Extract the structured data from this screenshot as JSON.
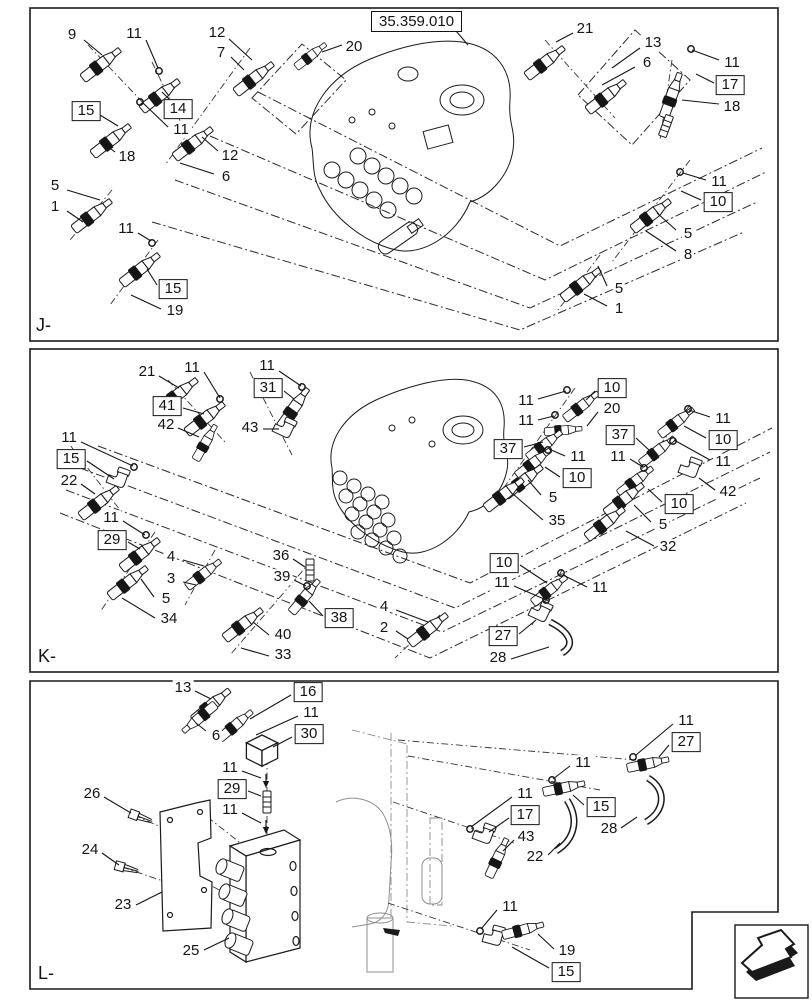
{
  "figure": {
    "reference_code": "35.359.010",
    "type": "hydraulic-valve-parts-diagram"
  },
  "colors": {
    "ink": "#1a1a1a",
    "frame_gray": "#8f8f8f"
  },
  "nav_arrow": {
    "meaning": "page-direction-arrow"
  },
  "panels": [
    {
      "id": "J",
      "label": "J-",
      "callouts": [
        {
          "t": "9",
          "x": 72,
          "y": 35,
          "l": [
            84,
            40,
            102,
            55
          ]
        },
        {
          "t": "11",
          "x": 134,
          "y": 34,
          "l": [
            146,
            40,
            158,
            68
          ]
        },
        {
          "t": "12",
          "x": 217,
          "y": 33,
          "l": [
            229,
            39,
            252,
            60
          ]
        },
        {
          "t": "7",
          "x": 221,
          "y": 53,
          "l": [
            231,
            57,
            244,
            70
          ]
        },
        {
          "t": "15",
          "b": 1,
          "x": 86,
          "y": 111,
          "l": [
            100,
            115,
            118,
            126
          ]
        },
        {
          "t": "14",
          "b": 1,
          "x": 178,
          "y": 109,
          "l": [
            170,
            100,
            162,
            92
          ]
        },
        {
          "t": "11",
          "x": 181,
          "y": 130,
          "l": [
            168,
            127,
            143,
            103
          ]
        },
        {
          "t": "18",
          "x": 127,
          "y": 157,
          "l": [
            115,
            152,
            102,
            142
          ]
        },
        {
          "t": "12",
          "x": 230,
          "y": 156,
          "l": [
            218,
            151,
            202,
            137
          ]
        },
        {
          "t": "6",
          "x": 226,
          "y": 177,
          "l": [
            214,
            174,
            180,
            163
          ]
        },
        {
          "t": "20",
          "x": 354,
          "y": 47,
          "l": [
            342,
            45,
            322,
            52
          ]
        },
        {
          "t": "21",
          "x": 585,
          "y": 29,
          "l": [
            573,
            33,
            556,
            42
          ]
        },
        {
          "t": "13",
          "x": 653,
          "y": 43,
          "l": [
            640,
            48,
            612,
            68
          ]
        },
        {
          "t": "6",
          "x": 647,
          "y": 63,
          "l": [
            635,
            67,
            602,
            85
          ]
        },
        {
          "t": "11",
          "x": 732,
          "y": 63,
          "l": [
            719,
            60,
            692,
            50
          ]
        },
        {
          "t": "17",
          "b": 1,
          "x": 730,
          "y": 85,
          "l": [
            714,
            83,
            696,
            74
          ]
        },
        {
          "t": "18",
          "x": 732,
          "y": 107,
          "l": [
            719,
            104,
            682,
            100
          ]
        },
        {
          "t": "11",
          "x": 719,
          "y": 182,
          "l": [
            706,
            180,
            683,
            173
          ]
        },
        {
          "t": "10",
          "b": 1,
          "x": 718,
          "y": 202,
          "l": [
            701,
            200,
            681,
            191
          ]
        },
        {
          "t": "5",
          "x": 688,
          "y": 234,
          "l": [
            676,
            230,
            657,
            213
          ]
        },
        {
          "t": "8",
          "x": 688,
          "y": 255,
          "l": [
            676,
            251,
            646,
            231
          ]
        },
        {
          "t": "5",
          "x": 619,
          "y": 289,
          "l": [
            607,
            286,
            598,
            266
          ]
        },
        {
          "t": "1",
          "x": 619,
          "y": 309,
          "l": [
            607,
            306,
            584,
            294
          ]
        },
        {
          "t": "5",
          "x": 55,
          "y": 186,
          "l": [
            67,
            190,
            100,
            200
          ]
        },
        {
          "t": "1",
          "x": 55,
          "y": 207,
          "l": [
            67,
            211,
            83,
            222
          ]
        },
        {
          "t": "11",
          "x": 126,
          "y": 229,
          "l": [
            138,
            233,
            151,
            241
          ]
        },
        {
          "t": "15",
          "b": 1,
          "x": 173,
          "y": 289,
          "l": [
            157,
            285,
            147,
            269
          ]
        },
        {
          "t": "19",
          "x": 175,
          "y": 311,
          "l": [
            161,
            309,
            131,
            295
          ]
        }
      ]
    },
    {
      "id": "K",
      "label": "K-",
      "callouts": [
        {
          "t": "21",
          "x": 147,
          "y": 372,
          "l": [
            159,
            376,
            179,
            388
          ]
        },
        {
          "t": "11",
          "x": 192,
          "y": 368,
          "l": [
            204,
            372,
            220,
            398
          ]
        },
        {
          "t": "41",
          "b": 1,
          "x": 167,
          "y": 406,
          "l": [
            183,
            408,
            204,
            414
          ]
        },
        {
          "t": "42",
          "x": 166,
          "y": 425,
          "l": [
            178,
            428,
            199,
            437
          ]
        },
        {
          "t": "11",
          "x": 267,
          "y": 366,
          "l": [
            279,
            371,
            301,
            386
          ]
        },
        {
          "t": "31",
          "b": 1,
          "x": 268,
          "y": 388,
          "l": [
            284,
            391,
            294,
            399
          ]
        },
        {
          "t": "43",
          "x": 250,
          "y": 428,
          "l": [
            263,
            429,
            279,
            429
          ]
        },
        {
          "t": "11",
          "x": 69,
          "y": 438,
          "l": [
            81,
            442,
            133,
            466
          ]
        },
        {
          "t": "15",
          "b": 1,
          "x": 71,
          "y": 459,
          "l": [
            87,
            461,
            114,
            479
          ]
        },
        {
          "t": "22",
          "x": 69,
          "y": 481,
          "l": [
            81,
            484,
            95,
            494
          ]
        },
        {
          "t": "11",
          "x": 111,
          "y": 518,
          "l": [
            123,
            521,
            145,
            535
          ]
        },
        {
          "t": "29",
          "b": 1,
          "x": 112,
          "y": 540,
          "l": [
            128,
            542,
            140,
            549
          ]
        },
        {
          "t": "5",
          "x": 166,
          "y": 599,
          "l": [
            154,
            597,
            141,
            579
          ]
        },
        {
          "t": "34",
          "x": 169,
          "y": 619,
          "l": [
            155,
            618,
            122,
            598
          ]
        },
        {
          "t": "4",
          "x": 171,
          "y": 557,
          "l": [
            183,
            560,
            204,
            566
          ]
        },
        {
          "t": "3",
          "x": 171,
          "y": 579,
          "l": [
            183,
            582,
            196,
            585
          ]
        },
        {
          "t": "36",
          "x": 281,
          "y": 556,
          "l": [
            293,
            559,
            305,
            567
          ]
        },
        {
          "t": "39",
          "x": 282,
          "y": 577,
          "l": [
            294,
            580,
            306,
            586
          ]
        },
        {
          "t": "40",
          "x": 283,
          "y": 635,
          "l": [
            269,
            635,
            253,
            622
          ]
        },
        {
          "t": "33",
          "x": 283,
          "y": 655,
          "l": [
            269,
            656,
            241,
            648
          ]
        },
        {
          "t": "38",
          "b": 1,
          "x": 339,
          "y": 618,
          "l": [
            323,
            616,
            309,
            601
          ]
        },
        {
          "t": "4",
          "x": 384,
          "y": 607,
          "l": [
            396,
            610,
            428,
            622
          ]
        },
        {
          "t": "2",
          "x": 384,
          "y": 628,
          "l": [
            396,
            631,
            408,
            639
          ]
        },
        {
          "t": "10",
          "b": 1,
          "x": 504,
          "y": 563,
          "l": [
            520,
            565,
            547,
            583
          ]
        },
        {
          "t": "11",
          "x": 502,
          "y": 583,
          "l": [
            514,
            586,
            544,
            599
          ]
        },
        {
          "t": "27",
          "b": 1,
          "x": 503,
          "y": 636,
          "l": [
            519,
            634,
            536,
            620
          ]
        },
        {
          "t": "28",
          "x": 498,
          "y": 658,
          "l": [
            511,
            659,
            549,
            647
          ]
        },
        {
          "t": "11",
          "x": 600,
          "y": 588,
          "l": [
            587,
            587,
            563,
            575
          ]
        },
        {
          "t": "11",
          "x": 526,
          "y": 401,
          "l": [
            538,
            399,
            566,
            391
          ]
        },
        {
          "t": "11",
          "x": 526,
          "y": 421,
          "l": [
            538,
            420,
            554,
            416
          ]
        },
        {
          "t": "10",
          "b": 1,
          "x": 612,
          "y": 388,
          "l": [
            595,
            391,
            586,
            400
          ]
        },
        {
          "t": "20",
          "x": 612,
          "y": 409,
          "l": [
            598,
            412,
            587,
            426
          ]
        },
        {
          "t": "37",
          "b": 1,
          "x": 508,
          "y": 449,
          "l": [
            524,
            447,
            543,
            442
          ]
        },
        {
          "t": "11",
          "x": 578,
          "y": 457,
          "l": [
            565,
            456,
            549,
            449
          ]
        },
        {
          "t": "10",
          "b": 1,
          "x": 577,
          "y": 478,
          "l": [
            560,
            477,
            545,
            467
          ]
        },
        {
          "t": "5",
          "x": 553,
          "y": 498,
          "l": [
            541,
            495,
            528,
            480
          ]
        },
        {
          "t": "35",
          "x": 557,
          "y": 521,
          "l": [
            543,
            520,
            513,
            494
          ]
        },
        {
          "t": "11",
          "x": 723,
          "y": 419,
          "l": [
            710,
            417,
            689,
            410
          ]
        },
        {
          "t": "10",
          "b": 1,
          "x": 723,
          "y": 440,
          "l": [
            706,
            438,
            684,
            426
          ]
        },
        {
          "t": "11",
          "x": 723,
          "y": 462,
          "l": [
            710,
            460,
            674,
            440
          ]
        },
        {
          "t": "42",
          "x": 728,
          "y": 492,
          "l": [
            715,
            490,
            699,
            478
          ]
        },
        {
          "t": "37",
          "b": 1,
          "x": 620,
          "y": 435,
          "l": [
            636,
            438,
            649,
            450
          ]
        },
        {
          "t": "11",
          "x": 618,
          "y": 457,
          "l": [
            630,
            459,
            643,
            467
          ]
        },
        {
          "t": "10",
          "b": 1,
          "x": 679,
          "y": 504,
          "l": [
            662,
            502,
            648,
            489
          ]
        },
        {
          "t": "5",
          "x": 663,
          "y": 525,
          "l": [
            651,
            522,
            634,
            505
          ]
        },
        {
          "t": "32",
          "x": 668,
          "y": 547,
          "l": [
            654,
            546,
            626,
            531
          ]
        }
      ]
    },
    {
      "id": "L",
      "label": "L-",
      "callouts": [
        {
          "t": "13",
          "x": 183,
          "y": 688,
          "l": [
            195,
            691,
            211,
            699
          ]
        },
        {
          "t": "16",
          "b": 1,
          "x": 308,
          "y": 692,
          "l": [
            291,
            695,
            250,
            719
          ]
        },
        {
          "t": "11",
          "x": 311,
          "y": 713,
          "l": [
            298,
            716,
            256,
            735
          ]
        },
        {
          "t": "30",
          "b": 1,
          "x": 309,
          "y": 734,
          "l": [
            292,
            737,
            273,
            747
          ]
        },
        {
          "t": "6",
          "x": 216,
          "y": 736,
          "l": [
            206,
            731,
            196,
            723
          ]
        },
        {
          "t": "11",
          "x": 230,
          "y": 768,
          "l": [
            242,
            771,
            261,
            778
          ]
        },
        {
          "t": "29",
          "b": 1,
          "x": 232,
          "y": 789,
          "l": [
            248,
            791,
            261,
            796
          ]
        },
        {
          "t": "11",
          "x": 230,
          "y": 810,
          "l": [
            242,
            813,
            261,
            823
          ]
        },
        {
          "t": "26",
          "x": 92,
          "y": 794,
          "l": [
            104,
            797,
            131,
            813
          ]
        },
        {
          "t": "24",
          "x": 90,
          "y": 850,
          "l": [
            102,
            853,
            119,
            865
          ]
        },
        {
          "t": "23",
          "x": 123,
          "y": 905,
          "l": [
            136,
            905,
            162,
            892
          ]
        },
        {
          "t": "25",
          "x": 191,
          "y": 951,
          "l": [
            204,
            950,
            229,
            938
          ]
        },
        {
          "t": "11",
          "x": 686,
          "y": 721,
          "l": [
            673,
            724,
            636,
            755
          ]
        },
        {
          "t": "27",
          "b": 1,
          "x": 686,
          "y": 742,
          "l": [
            669,
            745,
            659,
            757
          ]
        },
        {
          "t": "28",
          "x": 609,
          "y": 829,
          "l": [
            621,
            828,
            637,
            817
          ]
        },
        {
          "t": "11",
          "x": 583,
          "y": 763,
          "l": [
            570,
            766,
            553,
            779
          ]
        },
        {
          "t": "15",
          "b": 1,
          "x": 601,
          "y": 807,
          "l": [
            584,
            805,
            573,
            795
          ]
        },
        {
          "t": "22",
          "x": 535,
          "y": 857,
          "l": [
            548,
            855,
            560,
            843
          ]
        },
        {
          "t": "11",
          "x": 525,
          "y": 794,
          "l": [
            512,
            797,
            471,
            827
          ]
        },
        {
          "t": "17",
          "b": 1,
          "x": 525,
          "y": 815,
          "l": [
            509,
            818,
            489,
            832
          ]
        },
        {
          "t": "43",
          "x": 526,
          "y": 837,
          "l": [
            514,
            840,
            503,
            851
          ]
        },
        {
          "t": "11",
          "x": 510,
          "y": 907,
          "l": [
            497,
            910,
            481,
            929
          ]
        },
        {
          "t": "19",
          "x": 567,
          "y": 951,
          "l": [
            554,
            949,
            538,
            934
          ]
        },
        {
          "t": "15",
          "b": 1,
          "x": 566,
          "y": 972,
          "l": [
            549,
            968,
            512,
            947
          ]
        }
      ]
    }
  ]
}
